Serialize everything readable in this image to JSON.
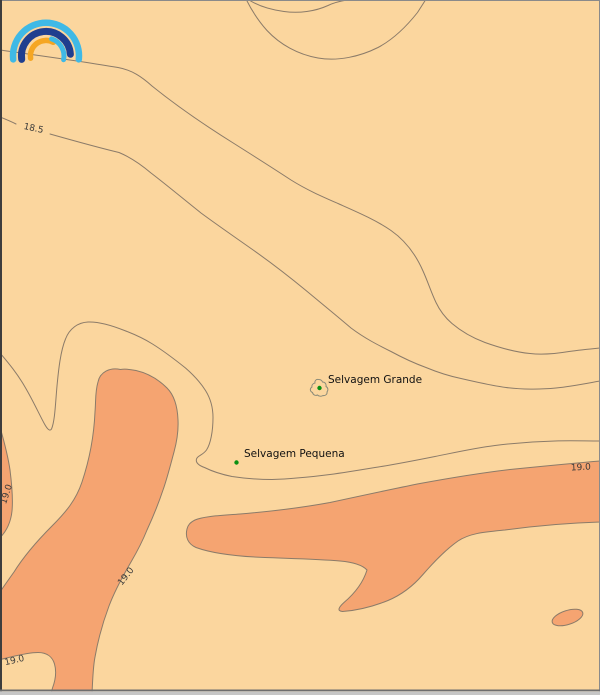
{
  "map": {
    "islands": [
      {
        "label": "Selvagem Grande"
      },
      {
        "label": "Selvagem Pequena"
      }
    ],
    "contour_labels": [
      {
        "text": "18.5"
      },
      {
        "text": "19.0"
      },
      {
        "text": "19.0"
      },
      {
        "text": "19.0"
      },
      {
        "text": "19.0"
      }
    ],
    "contour_levels": [
      "18.5",
      "19.0"
    ],
    "colors": {
      "sea_low": "#FBD69E",
      "sea_high": "#F5A471",
      "contour_line": "#8B7B69",
      "contour_label": "#3A3A3A",
      "island_outline": "#8A8A78",
      "island_marker": "#0B9012"
    }
  },
  "logo": {
    "name": "rainbow-arcs-logo",
    "colors": {
      "outer_arc": "#3FB9E6",
      "middle_arc": "#1F3E8F",
      "inner_left_arc": "#F5A623",
      "inner_right_arc": "#3FB9E6"
    }
  }
}
